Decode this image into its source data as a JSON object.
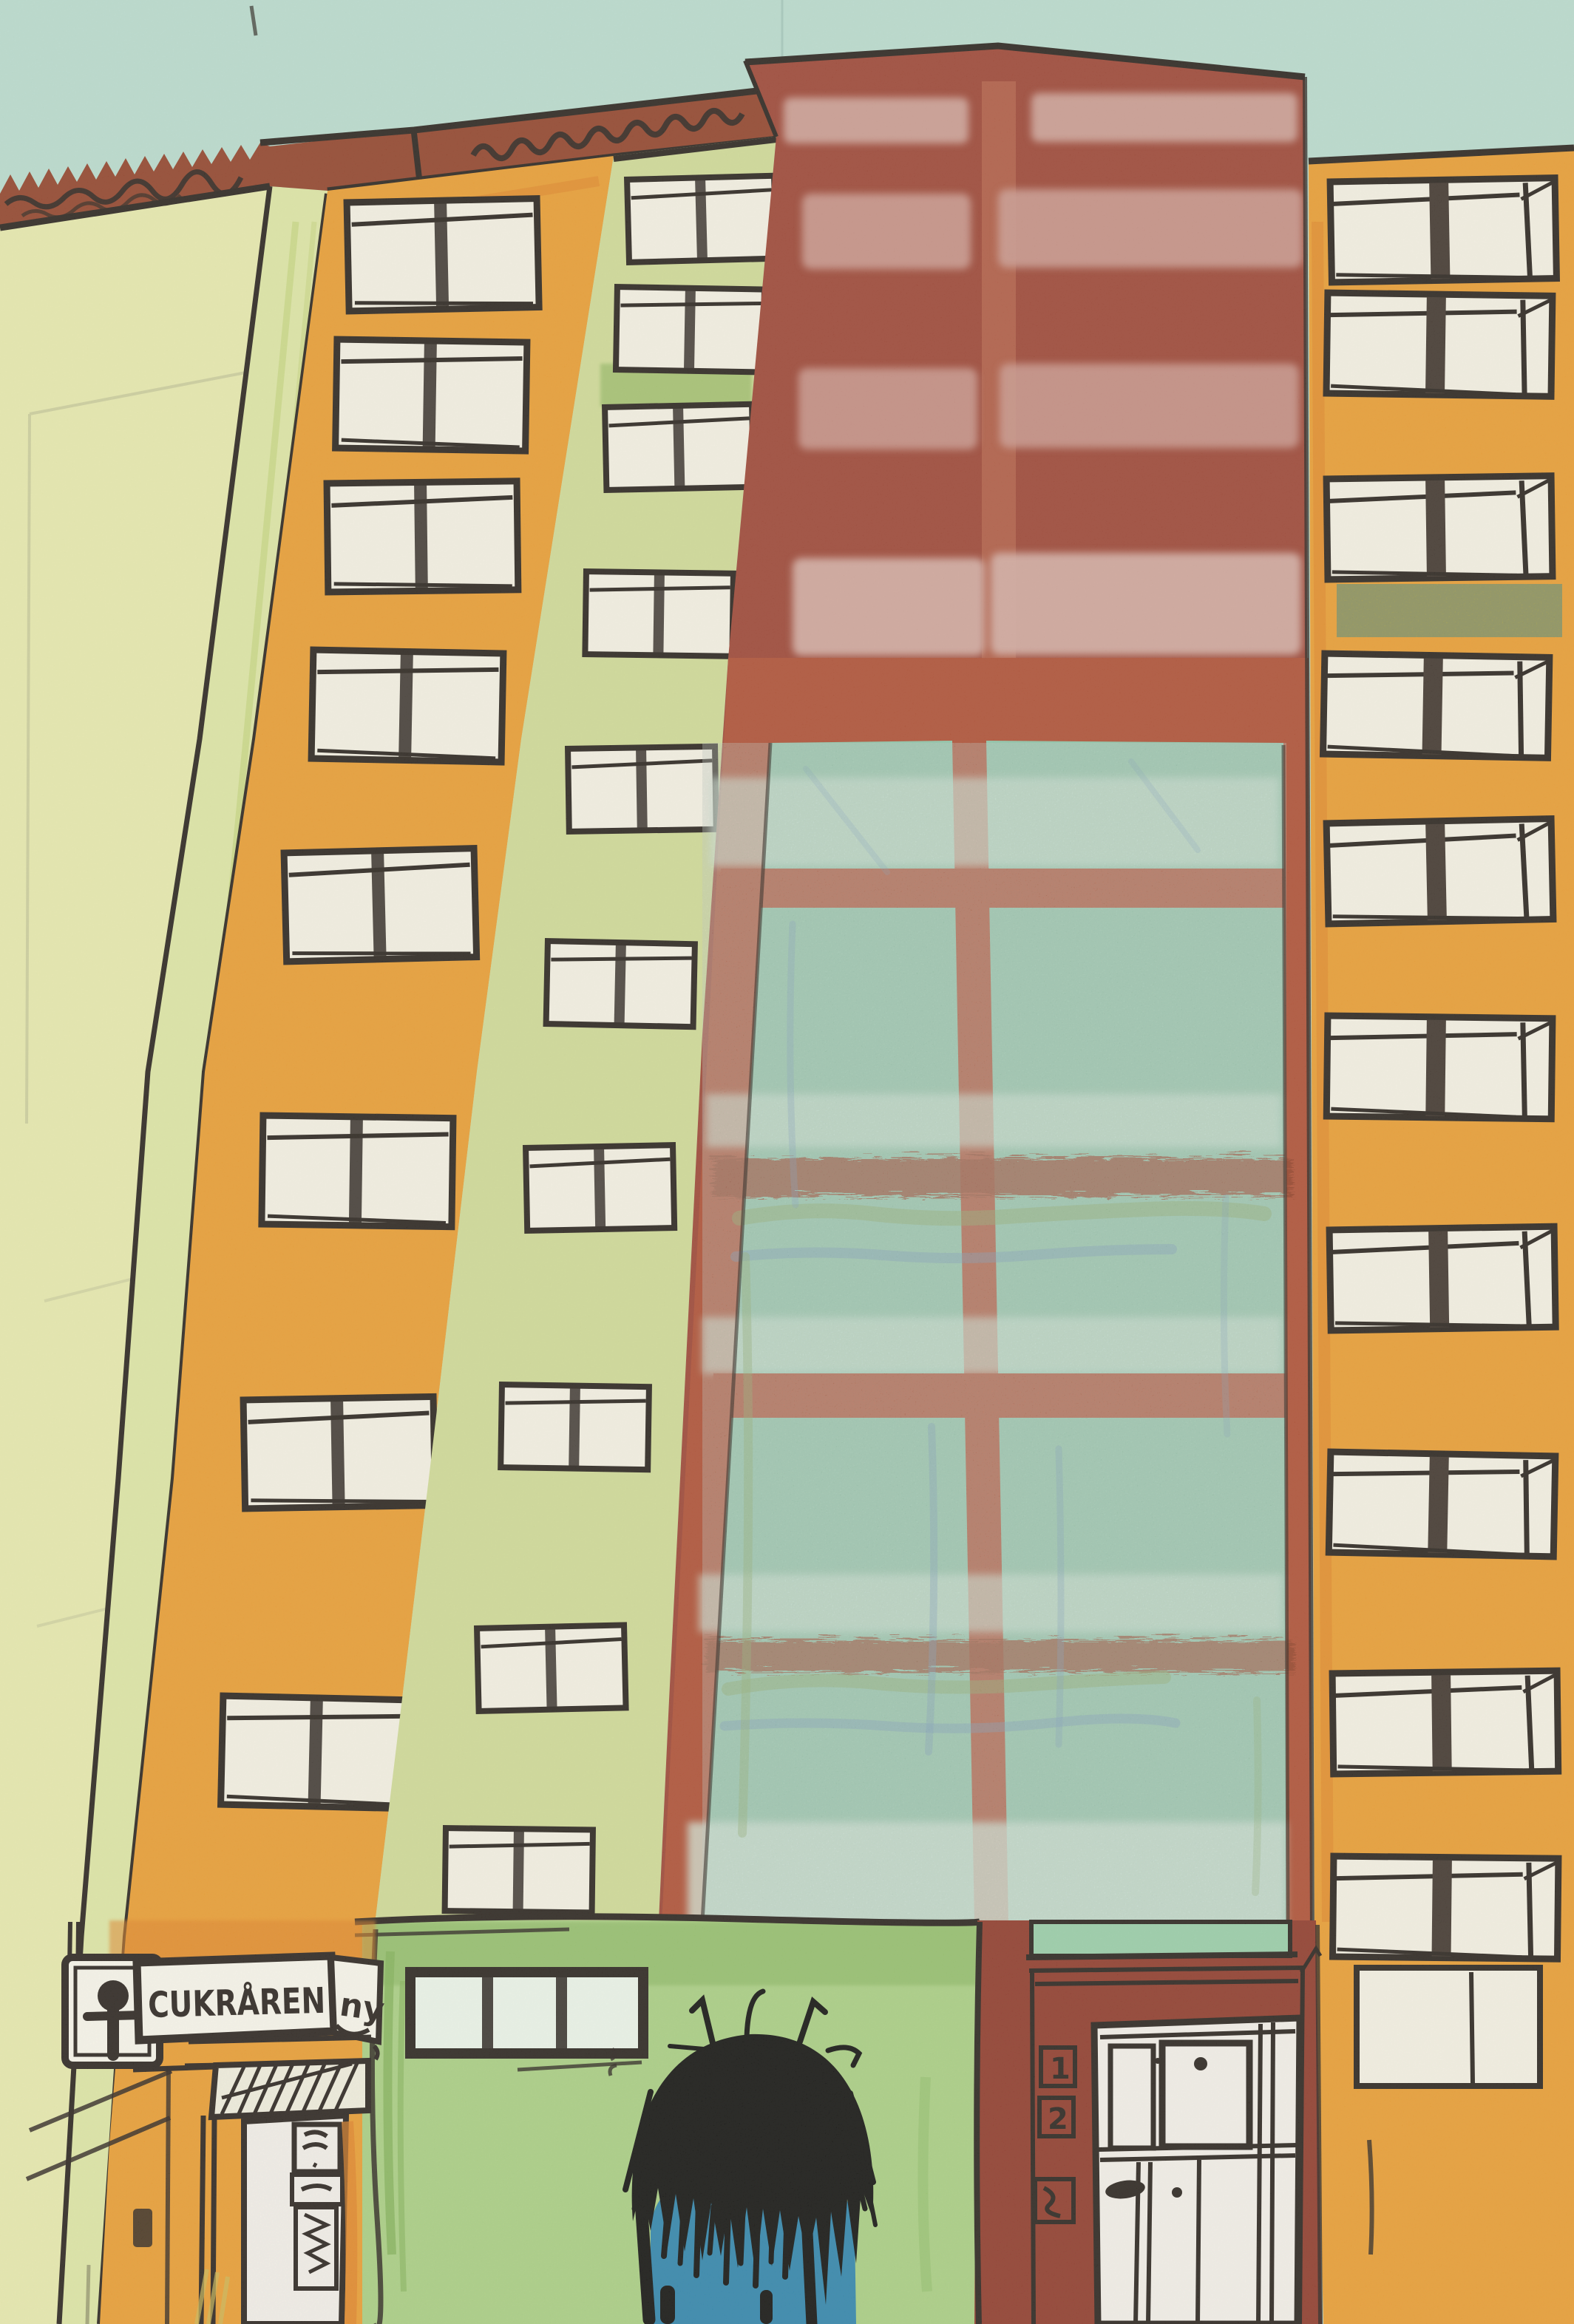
{
  "shop_sign": {
    "name": "CUKRÅREN",
    "suffix": "ny"
  },
  "entrance": {
    "unit_numbers": [
      "1",
      "2"
    ]
  },
  "colors": {
    "sky": "#b7d9cb",
    "wallLeft": "#e6e7a9",
    "wallStrip": "#dce4a0",
    "stripCrayon": "#c6d47d",
    "roofRed": "#8f3d24",
    "orange": "#e9992b",
    "orangeDeep": "#dd7b1e",
    "windowWhite": "#f3efe0",
    "ink": "#241c16",
    "greenStrip": "#ced892",
    "greenPatch": "#9cbb66",
    "redBlock": "#9a3f2e",
    "redStripe": "#b05940",
    "pinkPatch": "#c9958a",
    "pinkPatch2": "#d1a89d",
    "glassTeal": "#8cc2a5",
    "glassLight": "#d2e7d8",
    "mullionRed": "#ac4a2e",
    "streakRed": "#8e3b22",
    "crayonGreen": "#7ca04f",
    "crayonBlue": "#5f87b5",
    "oliveBand": "#a59d40",
    "shopGreen": "#a7cc7e",
    "shopGreenDark": "#7fae52",
    "paneGreen": "#eaf2e6",
    "transomGreen": "#96cba4",
    "doorRed": "#8c3424",
    "doorWhite": "#f2ede6",
    "signWhite": "#f7f4e9",
    "hair": "#0b0a08",
    "shirtBlue": "#2b80a8",
    "darkMullion": "#3b2f27"
  }
}
